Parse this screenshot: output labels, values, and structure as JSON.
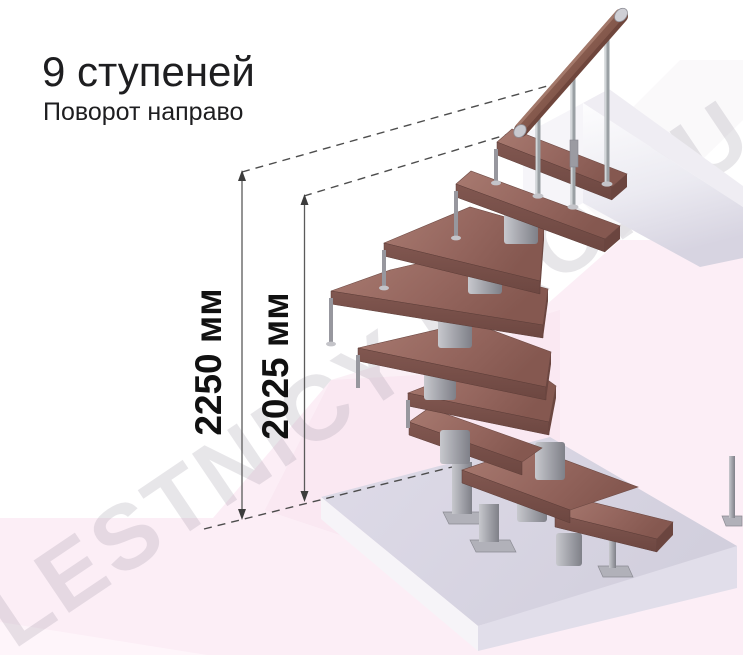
{
  "header": {
    "title": "9 ступеней",
    "subtitle": "Поворот направо"
  },
  "dimensions": {
    "outer_label": "2250 мм",
    "inner_label": "2025 мм"
  },
  "watermark": "LESTNICY-PRO.RU",
  "illustration": {
    "steps_total": "9",
    "turn_direction_note": "Поворот направо"
  },
  "colors": {
    "tread_wood": "#9a6b62",
    "tread_front": "#7c544e",
    "metal": "#a3a3aa",
    "handrail_wood": "#8a5c50",
    "upper_landing": "#e9e7f0",
    "base_slab_top": "#d8d5e2",
    "base_slab_side": "#f6f4f8",
    "background_pink": "#fceef6",
    "annotation": "#4d4d4d",
    "text": "#1e1e20"
  }
}
